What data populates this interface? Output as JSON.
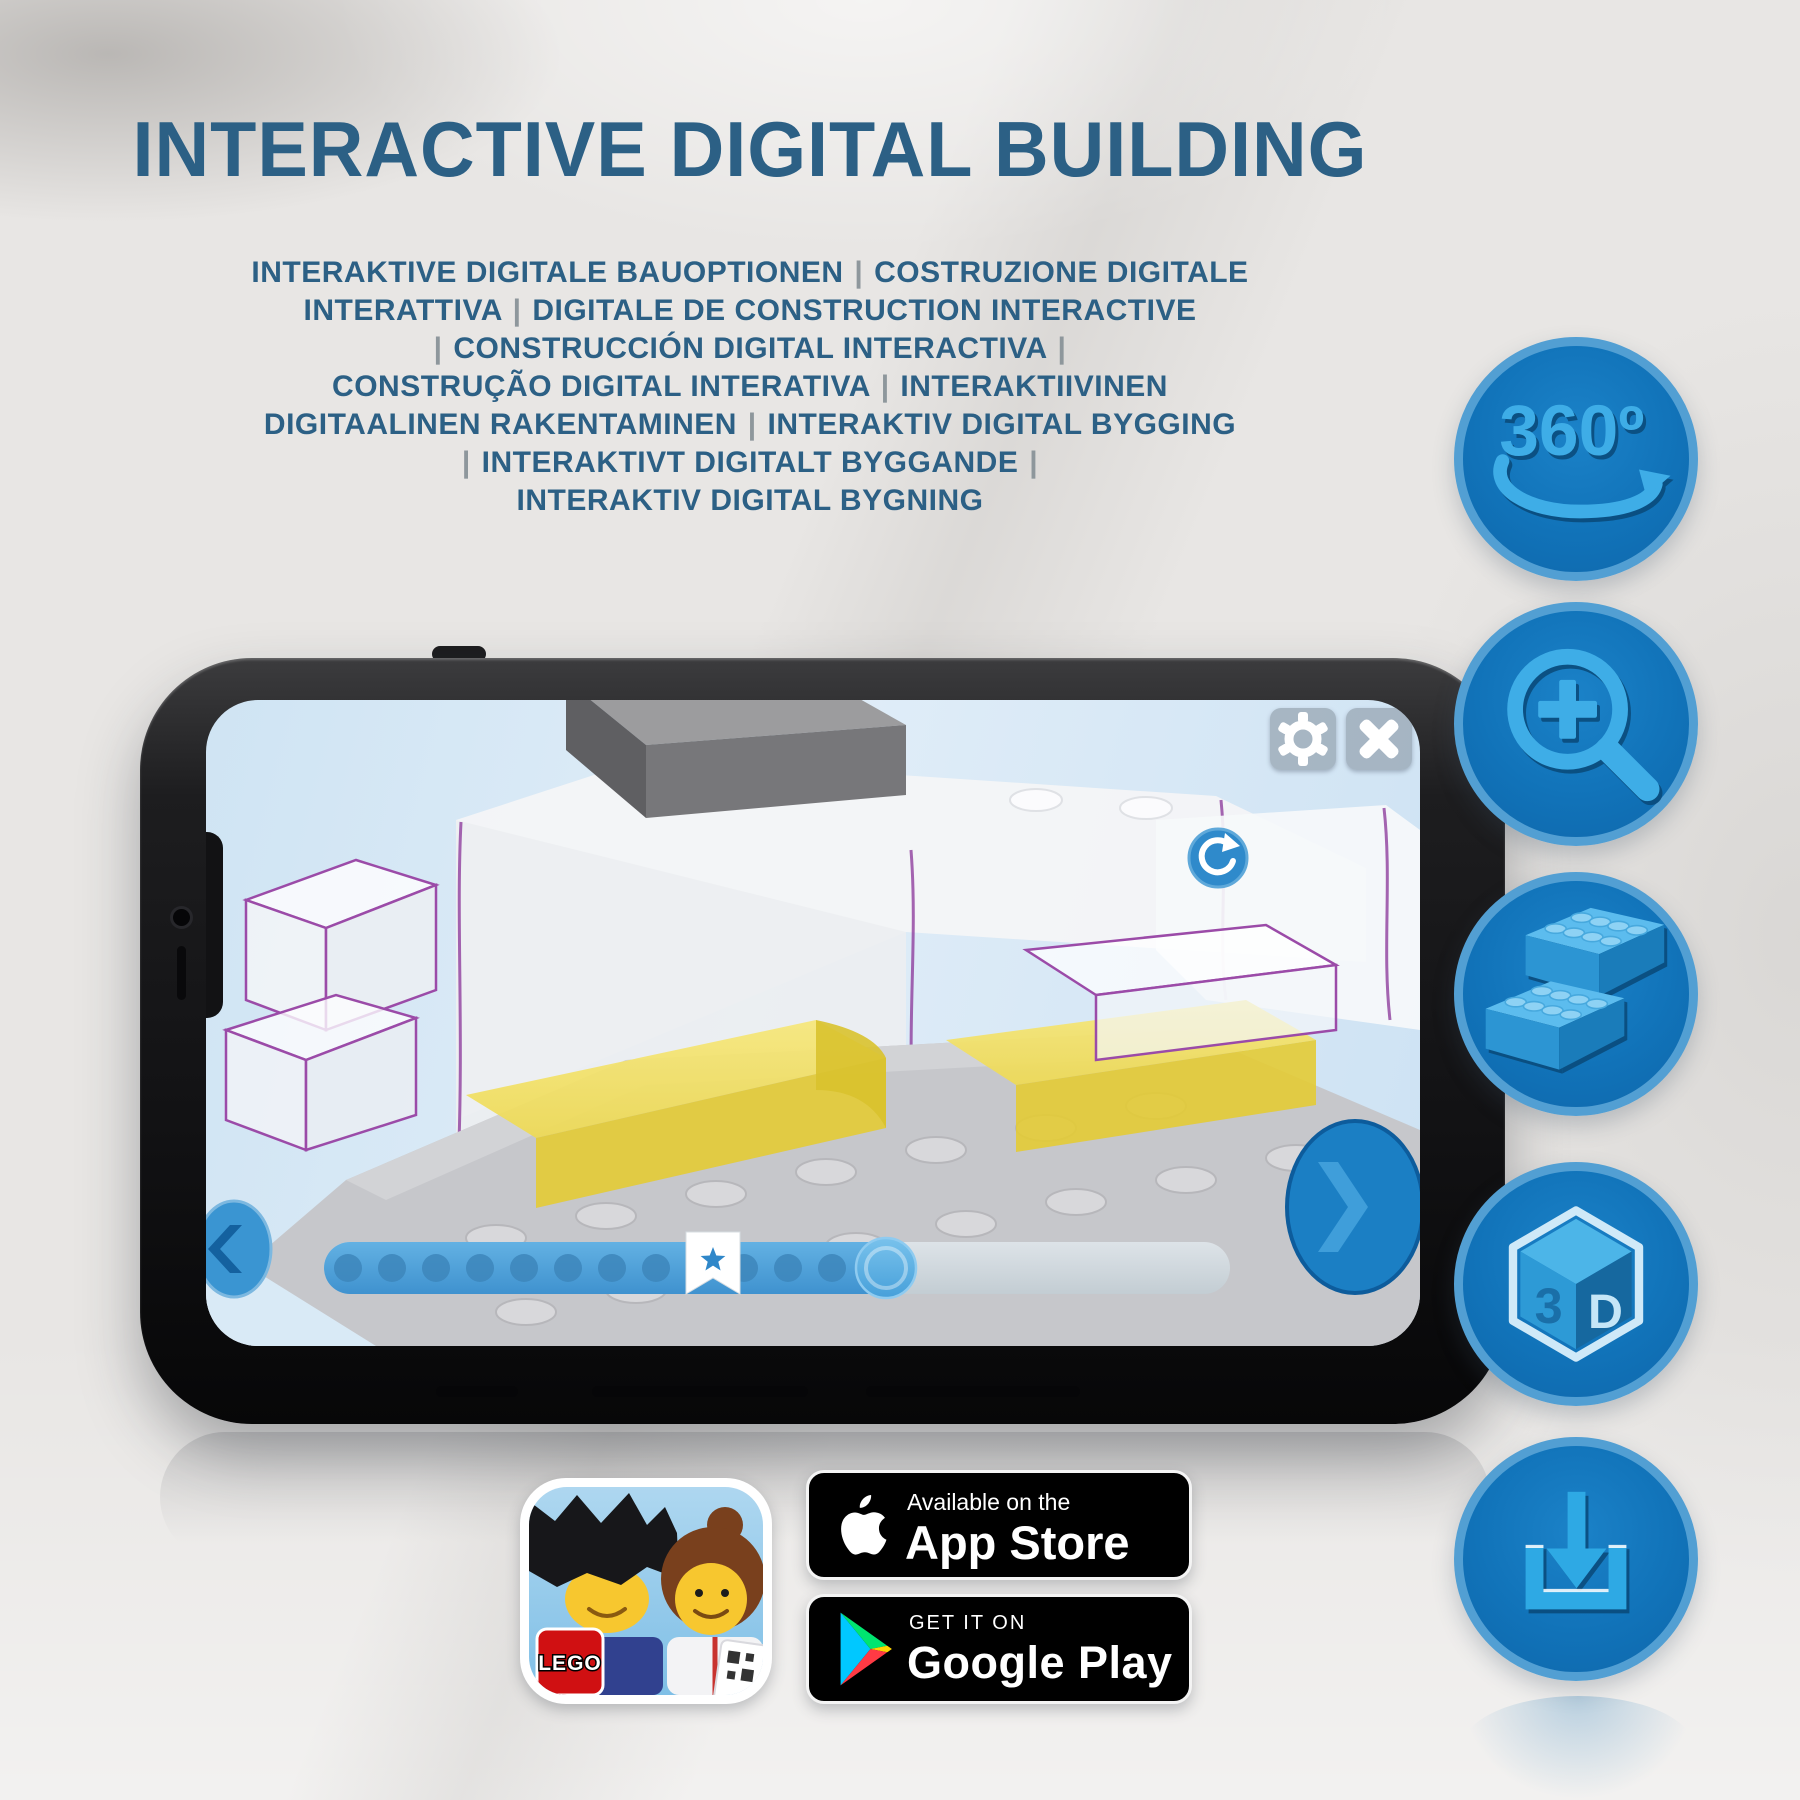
{
  "header": {
    "title": "INTERACTIVE DIGITAL BUILDING"
  },
  "subtitle": {
    "lines": [
      "INTERAKTIVE DIGITALE BAUOPTIONEN | COSTRUZIONE DIGITALE",
      "INTERATTIVA | DIGITALE DE CONSTRUCTION INTERACTIVE",
      "| CONSTRUCCIÓN DIGITAL INTERACTIVA |",
      "CONSTRUÇÃO DIGITAL INTERATIVA | INTERAKTIIVINEN",
      "DIGITAALINEN RAKENTAMINEN | INTERAKTIV DIGITAL BYGGING",
      "| INTERAKTIVT DIGITALT BYGGANDE |",
      "INTERAKTIV DIGITAL BYGNING"
    ]
  },
  "feature_icons": [
    {
      "name": "360-rotation",
      "label": "360º"
    },
    {
      "name": "zoom-in",
      "label": ""
    },
    {
      "name": "lego-bricks",
      "label": ""
    },
    {
      "name": "3d-view",
      "label": "",
      "cube_left": "3",
      "cube_right": "D"
    },
    {
      "name": "download",
      "label": ""
    }
  ],
  "phone": {
    "progress": {
      "dot_count": 12,
      "dot_start_x": 24,
      "dot_spacing": 44,
      "dot_cy": 38,
      "dot_radius": 14,
      "dot_color": "#3d86bb"
    }
  },
  "badges": {
    "lego_app": {
      "logo_text": "LEGO"
    },
    "app_store": {
      "tagline": "Available on the",
      "store_name": "App Store"
    },
    "google_play": {
      "tagline": "GET IT ON",
      "store_name": "Google Play"
    }
  },
  "colors": {
    "title_blue": "#2c6085",
    "icon_circle": "#1173b9",
    "icon_glyph": "#3eade7",
    "yellow_brick": "#f1df63",
    "purple_outline": "#9b4ba8",
    "progress_fill": "#4a9ed9"
  }
}
